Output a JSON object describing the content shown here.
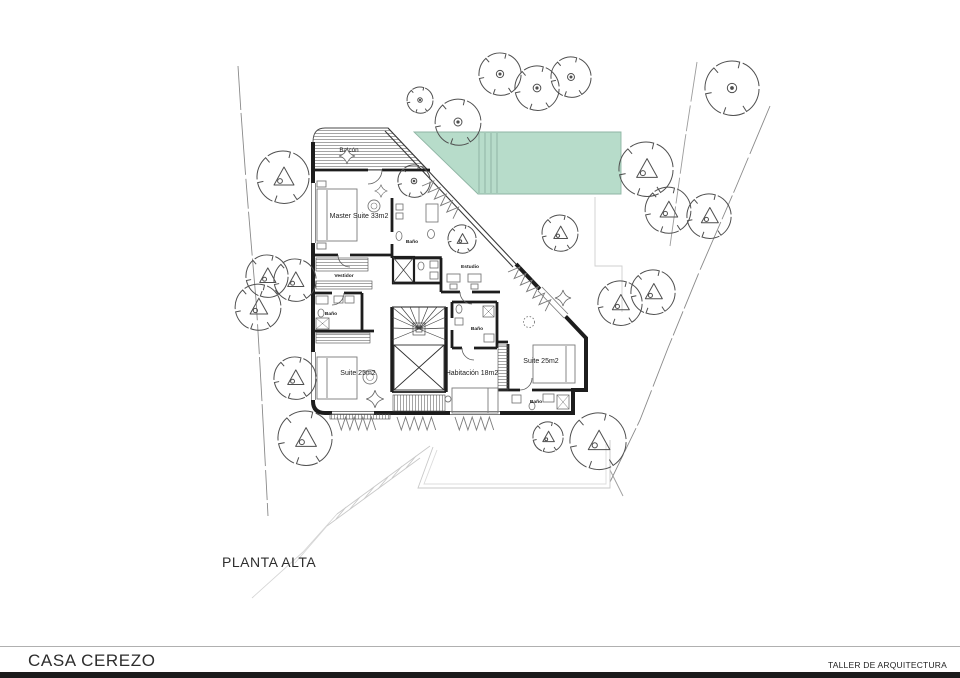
{
  "plan": {
    "label": "PLANTA ALTA"
  },
  "footer": {
    "project_title": "CASA CEREZO",
    "studio_name": "TALLER DE ARQUITECTURA"
  },
  "rooms": {
    "balcony": "Balcón",
    "master_suite": "Master Suite 33m2",
    "wardrobe": "Vestidor",
    "bathroom": "Baño",
    "study": "Estudio",
    "suite_left": "Suite 25m2",
    "bedroom": "Habitación 18m2",
    "suite_right": "Suite 25m2"
  },
  "colors": {
    "pool_fill": "#b7dcca",
    "pool_edge": "#8fb5a4",
    "wall": "#1d1d1d",
    "vegetation_stroke": "#4f4f4f"
  }
}
